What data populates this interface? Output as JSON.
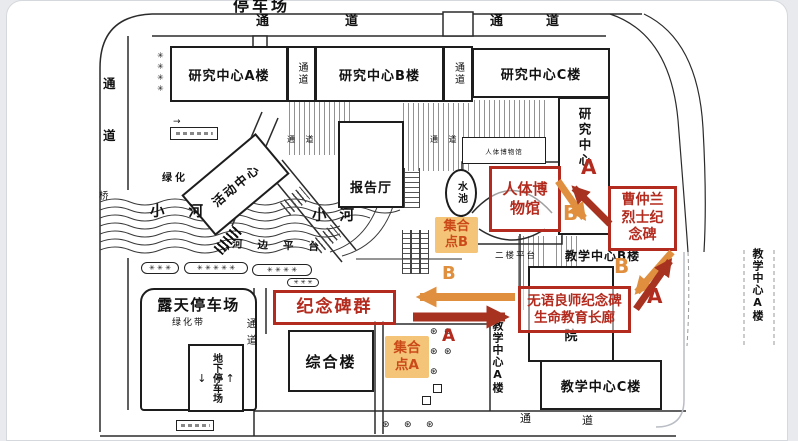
{
  "colors": {
    "red": "#b32b1e",
    "dark_red": "#a83220",
    "orange": "#e08f3e",
    "meet_bg": "#f4c478",
    "meet_text": "#cb4a1a",
    "map_line": "#2b2b2b",
    "page_bg": "#e8eaed"
  },
  "symbols": {
    "tree": "✳",
    "round_tree": "⊛",
    "up_arrow": "↑",
    "down_arrow": "↓",
    "ne_arrow": "↗",
    "right_arrow": "→",
    "planter3": "✳ ✳ ✳",
    "planter4": "✳ ✳ ✳ ✳",
    "planter5": "✳ ✳ ✳ ✳ ✳"
  },
  "top": {
    "title": "停车场",
    "c1": "通",
    "c2": "道",
    "c3": "通",
    "c4": "道"
  },
  "roads": {
    "left_c1": "通",
    "left_c2": "道",
    "bridge": "桥",
    "inner_v": "通道",
    "walk1": "通 道",
    "walk2": "通 道",
    "bottom_c1": "通",
    "bottom_c2": "道"
  },
  "buildings": {
    "research_a": "研究中心A楼",
    "corridor": "通道",
    "research_b": "研究中心B楼",
    "research_c": "研究中心C楼",
    "research_wing": "研究中心",
    "museum_small": "人体博物馆",
    "lecture": "报告厅",
    "pool": "水池",
    "activity": "活动中心",
    "complex": "综合楼",
    "teaching_b": "教学中心B楼",
    "teaching_c": "教学中心C楼",
    "teaching_a": "教学中心A楼",
    "yuan": "院",
    "platform2": "二楼平台",
    "riverside": "河边平台",
    "river": "小河",
    "green": "绿化",
    "green_belt": "绿化带",
    "open_parking": "露天停车场",
    "underground": "地下停车场"
  },
  "annotations": {
    "museum": "人体博物馆",
    "caozhonglan": "曹仲兰烈士纪念碑",
    "monuments": "纪念碑群",
    "wuyu_line1": "无语良师纪念碑",
    "wuyu_line2": "生命教育长廊",
    "meet_line1": "集合",
    "meet_a_line2": "点A",
    "meet_b_line2": "点B",
    "letter_a": "A",
    "letter_b": "B"
  }
}
